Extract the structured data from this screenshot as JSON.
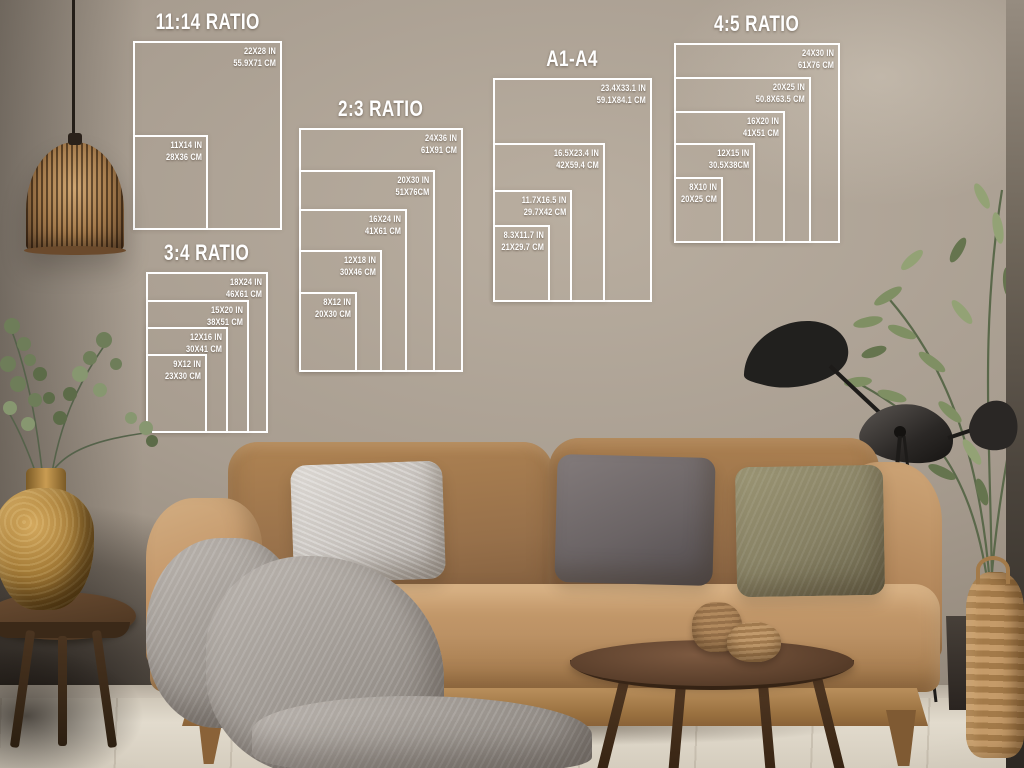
{
  "guides": [
    {
      "id": "11-14",
      "title": "11:14 RATIO",
      "sizes": [
        {
          "in": "22X28 IN",
          "cm": "55.9X71 CM"
        },
        {
          "in": "11X14 IN",
          "cm": "28X36 CM"
        }
      ]
    },
    {
      "id": "2-3",
      "title": "2:3 RATIO",
      "sizes": [
        {
          "in": "24X36 IN",
          "cm": "61X91 CM"
        },
        {
          "in": "20X30 IN",
          "cm": "51X76CM"
        },
        {
          "in": "16X24 IN",
          "cm": "41X61 CM"
        },
        {
          "in": "12X18 IN",
          "cm": "30X46 CM"
        },
        {
          "in": "8X12 IN",
          "cm": "20X30 CM"
        }
      ]
    },
    {
      "id": "3-4",
      "title": "3:4 RATIO",
      "sizes": [
        {
          "in": "18X24 IN",
          "cm": "46X61 CM"
        },
        {
          "in": "15X20 IN",
          "cm": "38X51 CM"
        },
        {
          "in": "12X16 IN",
          "cm": "30X41 CM"
        },
        {
          "in": "9X12 IN",
          "cm": "23X30 CM"
        }
      ]
    },
    {
      "id": "a1-a4",
      "title": "A1-A4",
      "sizes": [
        {
          "in": "23.4X33.1 IN",
          "cm": "59.1X84.1 CM"
        },
        {
          "in": "16.5X23.4 IN",
          "cm": "42X59.4 CM"
        },
        {
          "in": "11.7X16.5 IN",
          "cm": "29.7X42 CM"
        },
        {
          "in": "8.3X11.7 IN",
          "cm": "21X29.7 CM"
        }
      ]
    },
    {
      "id": "4-5",
      "title": "4:5 RATIO",
      "sizes": [
        {
          "in": "24X30 IN",
          "cm": "61X76 CM"
        },
        {
          "in": "20X25 IN",
          "cm": "50.8X63.5 CM"
        },
        {
          "in": "16X20 IN",
          "cm": "41X51 CM"
        },
        {
          "in": "12X15 IN",
          "cm": "30.5X38CM"
        },
        {
          "in": "8X10 IN",
          "cm": "20X25 CM"
        }
      ]
    }
  ],
  "colors": {
    "line": "#ffffff",
    "wall": "#a89d90",
    "floor": "#ddd6c8",
    "sofa": "#bb9164",
    "sofa_back": "#97704a",
    "pillow_light": "#cdc8c2",
    "pillow_dark": "#6b6465",
    "pillow_olive": "#8e8a6d",
    "blanket": "#a39d97",
    "wood_dark": "#533927",
    "gold": "#a57c38",
    "leaf": "#7d8d61",
    "lamp_black": "#1f1d1b",
    "basket": "#b98f5e",
    "cord": "#241e18"
  }
}
